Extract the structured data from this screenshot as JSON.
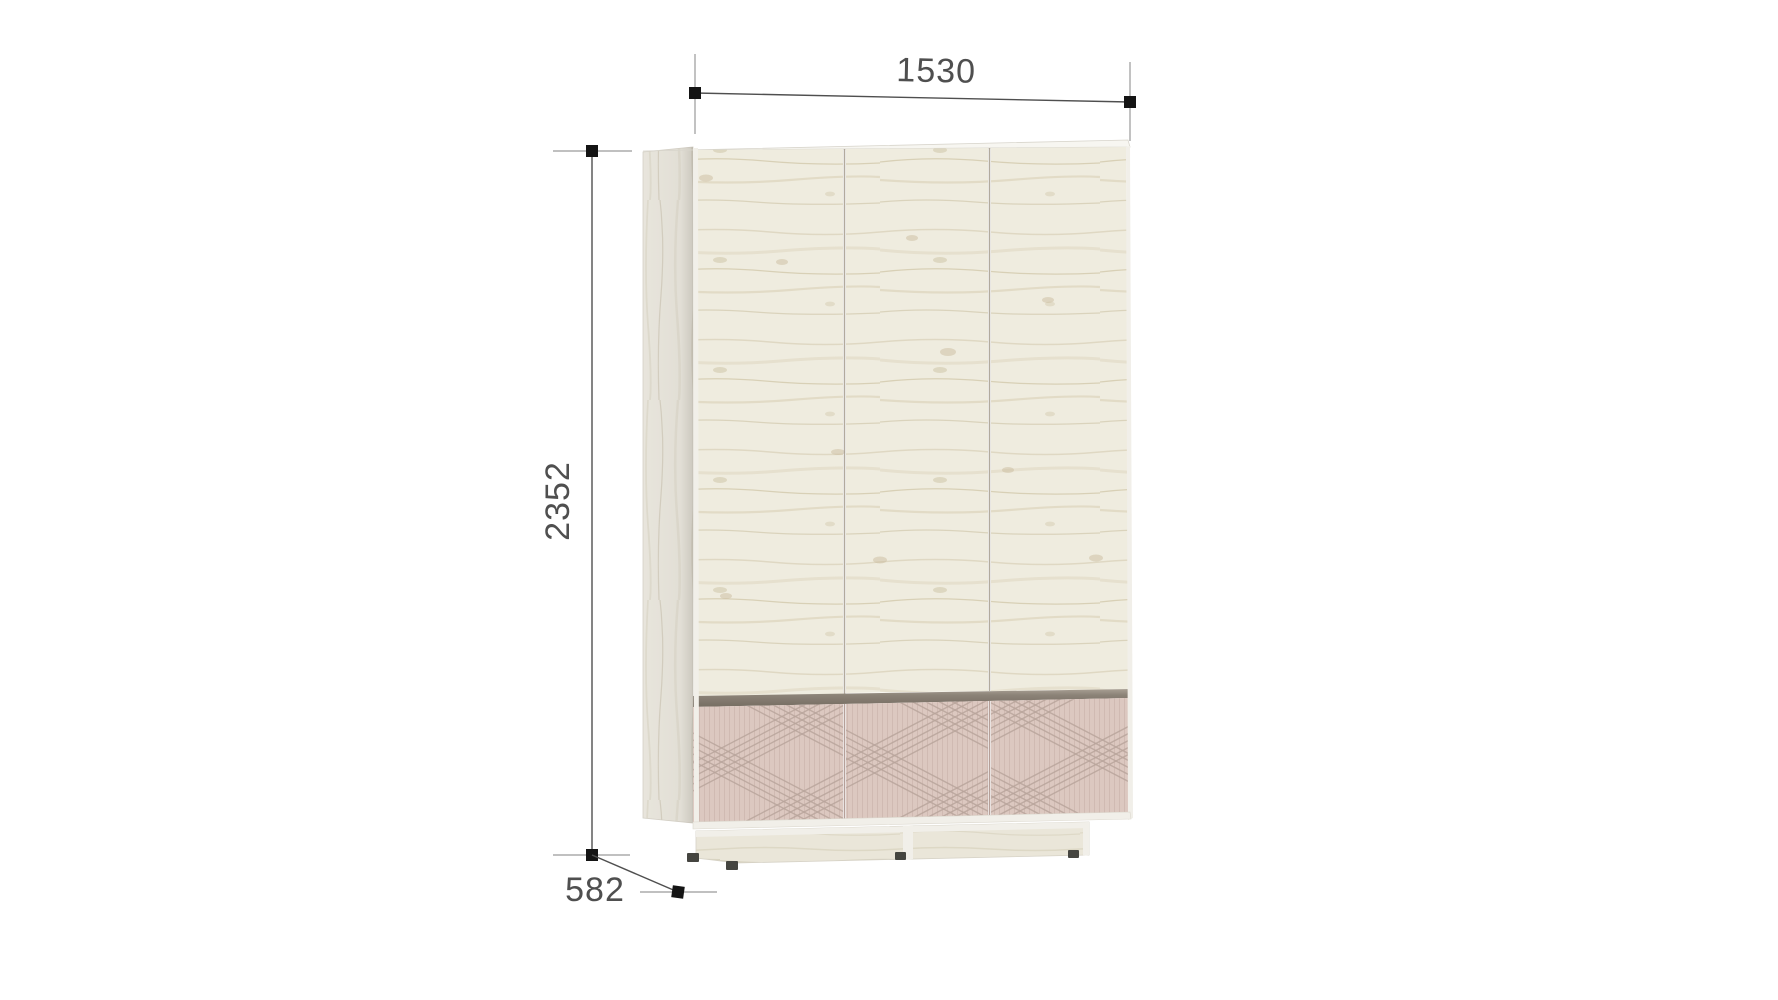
{
  "diagram": {
    "type": "furniture-dimension-drawing",
    "product": "three-door wardrobe with drawer base",
    "dimensions": {
      "width": {
        "label": "1530"
      },
      "height": {
        "label": "2352"
      },
      "depth": {
        "label": "582"
      }
    }
  },
  "colors": {
    "background": "#ffffff",
    "dim_line": "#4f4f4f",
    "ext_line": "#9a9a9a",
    "marker": "#141414",
    "label_text": "#4f4f4f",
    "top_white": "#f7f6f1",
    "edge_white": "#f1efe9",
    "groove_dark": "#877d71",
    "drawer_pink": "#dcc8c0",
    "feet_dark": "#454540"
  }
}
